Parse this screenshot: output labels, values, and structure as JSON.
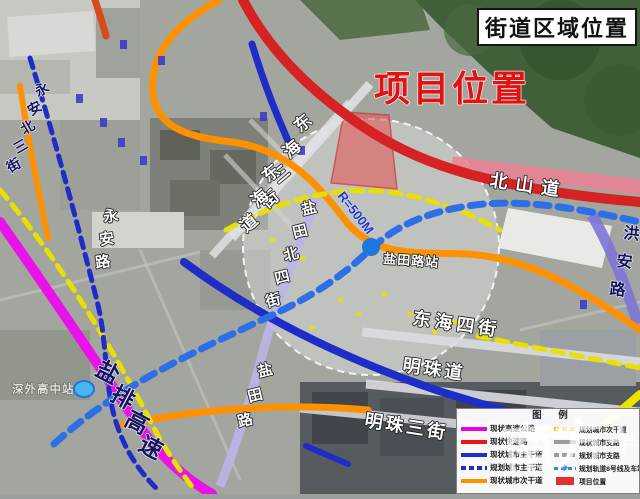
{
  "header": {
    "title": "街道区域位置"
  },
  "annotations": {
    "project_location": "项目位置",
    "radius": "R=500M"
  },
  "stations": {
    "yantian_road": "盐田路站",
    "shenwai_senior_high": "深外高中站"
  },
  "roads": {
    "donghai_3rd": "东海三街",
    "donghai_ave": "东海道",
    "beishan_ave": "北山道",
    "hongan_rd": "洪安路",
    "yongan_n3": "永安北三街",
    "yongan_rd": "永安路",
    "yantian_n4": "盐田北四街",
    "yantian_rd": "盐田路",
    "donghai_4th": "东海四街",
    "mingzhu_ave": "明珠道",
    "mingzhu_3rd": "明珠三街",
    "yanpai_expwy": "盐排高速"
  },
  "legend": {
    "title": "图 例",
    "station_icon": "◆",
    "left": [
      {
        "label": "现状高速公路",
        "swatch": "solid",
        "color": "#e800e8"
      },
      {
        "label": "现状快速路",
        "swatch": "solid",
        "color": "#e81515"
      },
      {
        "label": "现状城市主干道",
        "swatch": "solid",
        "color": "#1d2fd0"
      },
      {
        "label": "规划城市主干道",
        "swatch": "dashed",
        "color": "#1d2fd0"
      },
      {
        "label": "现状城市次干道",
        "swatch": "solid",
        "color": "#ff9100"
      }
    ],
    "right": [
      {
        "label": "规划城市次干道",
        "swatch": "dashed",
        "color": "#ddcc00"
      },
      {
        "label": "现状城市支路",
        "swatch": "solid",
        "color": "#9b9b9b"
      },
      {
        "label": "规划城市支路",
        "swatch": "dashed",
        "color": "#9b9b9b"
      },
      {
        "label": "规划轨道8号线及车站",
        "swatch": "rail",
        "color": "#2f86f0"
      },
      {
        "label": "项目位置",
        "swatch": "block",
        "color": "#e03030"
      }
    ]
  },
  "watermark": {
    "text": "南方+"
  },
  "colors": {
    "expressway_magenta": "#ea12ea",
    "fastroad_red": "#d62222",
    "arterial_blue": "#1e2cc8",
    "secondary_orange": "#ff9100",
    "planned_yellow": "#e8e000",
    "metro_blue": "#2e6fe8",
    "project_fill": "#e45050"
  }
}
